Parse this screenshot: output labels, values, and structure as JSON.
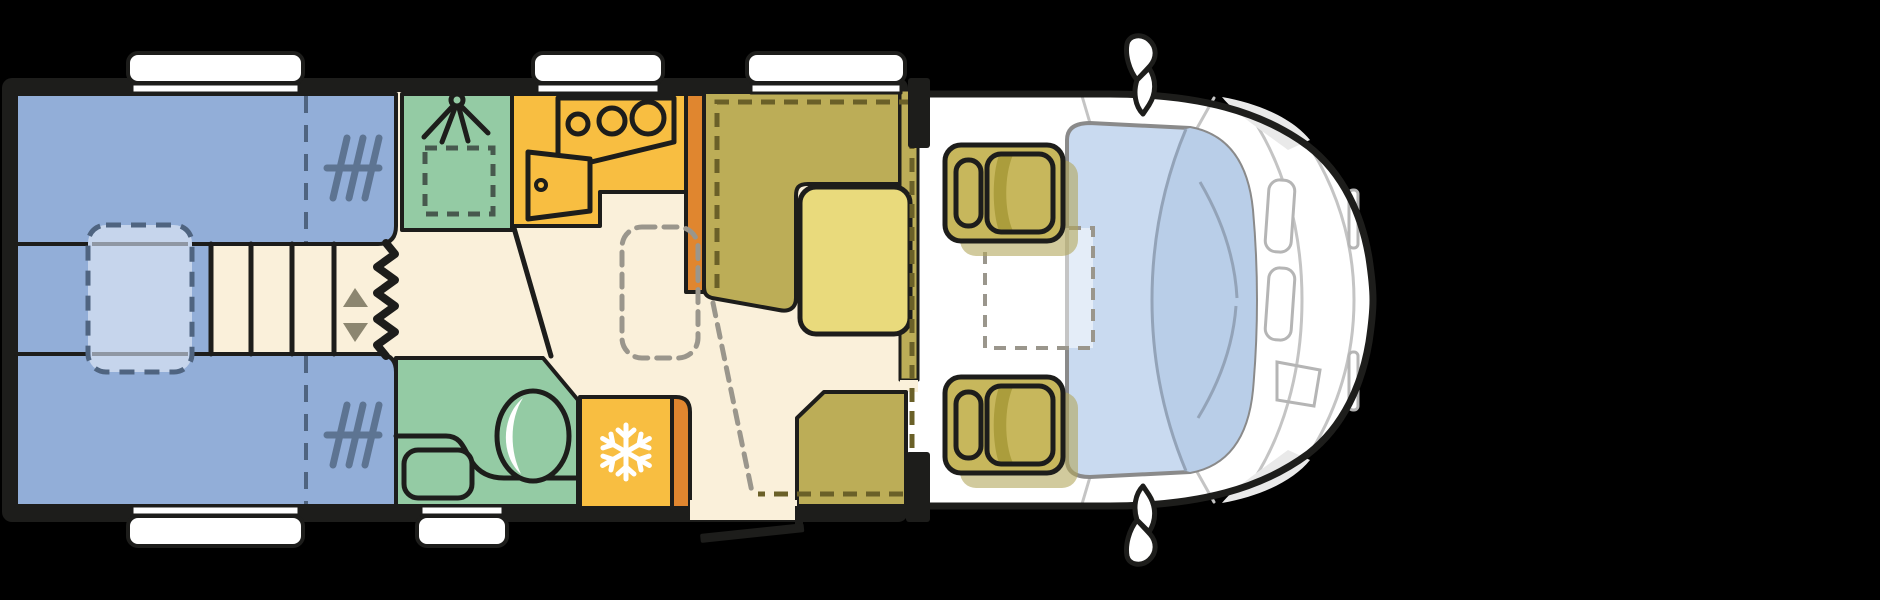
{
  "title": "motorhome-top-view-floorplan",
  "canvas": {
    "width": 1880,
    "height": 600,
    "background": "#000000"
  },
  "colors": {
    "background": "#000000",
    "outline": "#1d1d1b",
    "floor": "#faf0da",
    "bed_blue": "#92aed8",
    "bed_insert_blue": "#c6d5ec",
    "bed_divider": "#4f6480",
    "insert_edge_gray": "#8f97a3",
    "mattress_mark": "#5d7492",
    "step_arrow": "#8c8670",
    "shower_green": "#94cba4",
    "shower_tray": "#cbe5cf",
    "tray_dash": "#47594e",
    "kitchen_yellow": "#f8be41",
    "accent_orange": "#e0862f",
    "bench_olive": "#bcad57",
    "table_yellow": "#e9da7c",
    "bed_dash_olive": "#6a6028",
    "floor_dash_gray": "#9a968c",
    "seat_olive": "#c7b75c",
    "seat_shadow": "#b3a65c",
    "seat_accent": "#ab9d3c",
    "windshield_blue": "#c9daf0",
    "windshield_shade": "#b9cee8",
    "windshield_line": "#93a3b8",
    "glass_outline": "#8a8a8a",
    "body_white": "#ffffff",
    "body_detail": "#c4c4c4",
    "body_detail_light": "#b5b5b5",
    "body_wedge": "#e9e9e9",
    "window_white": "#ffffff",
    "white": "#ffffff"
  },
  "icons": {
    "shower": "shower-head-icon",
    "fridge": "snowflake-icon",
    "toilet": "crescent-moon-icon",
    "beds": "mattress-hatch-icon",
    "steps": "up-down-arrows-icon"
  }
}
